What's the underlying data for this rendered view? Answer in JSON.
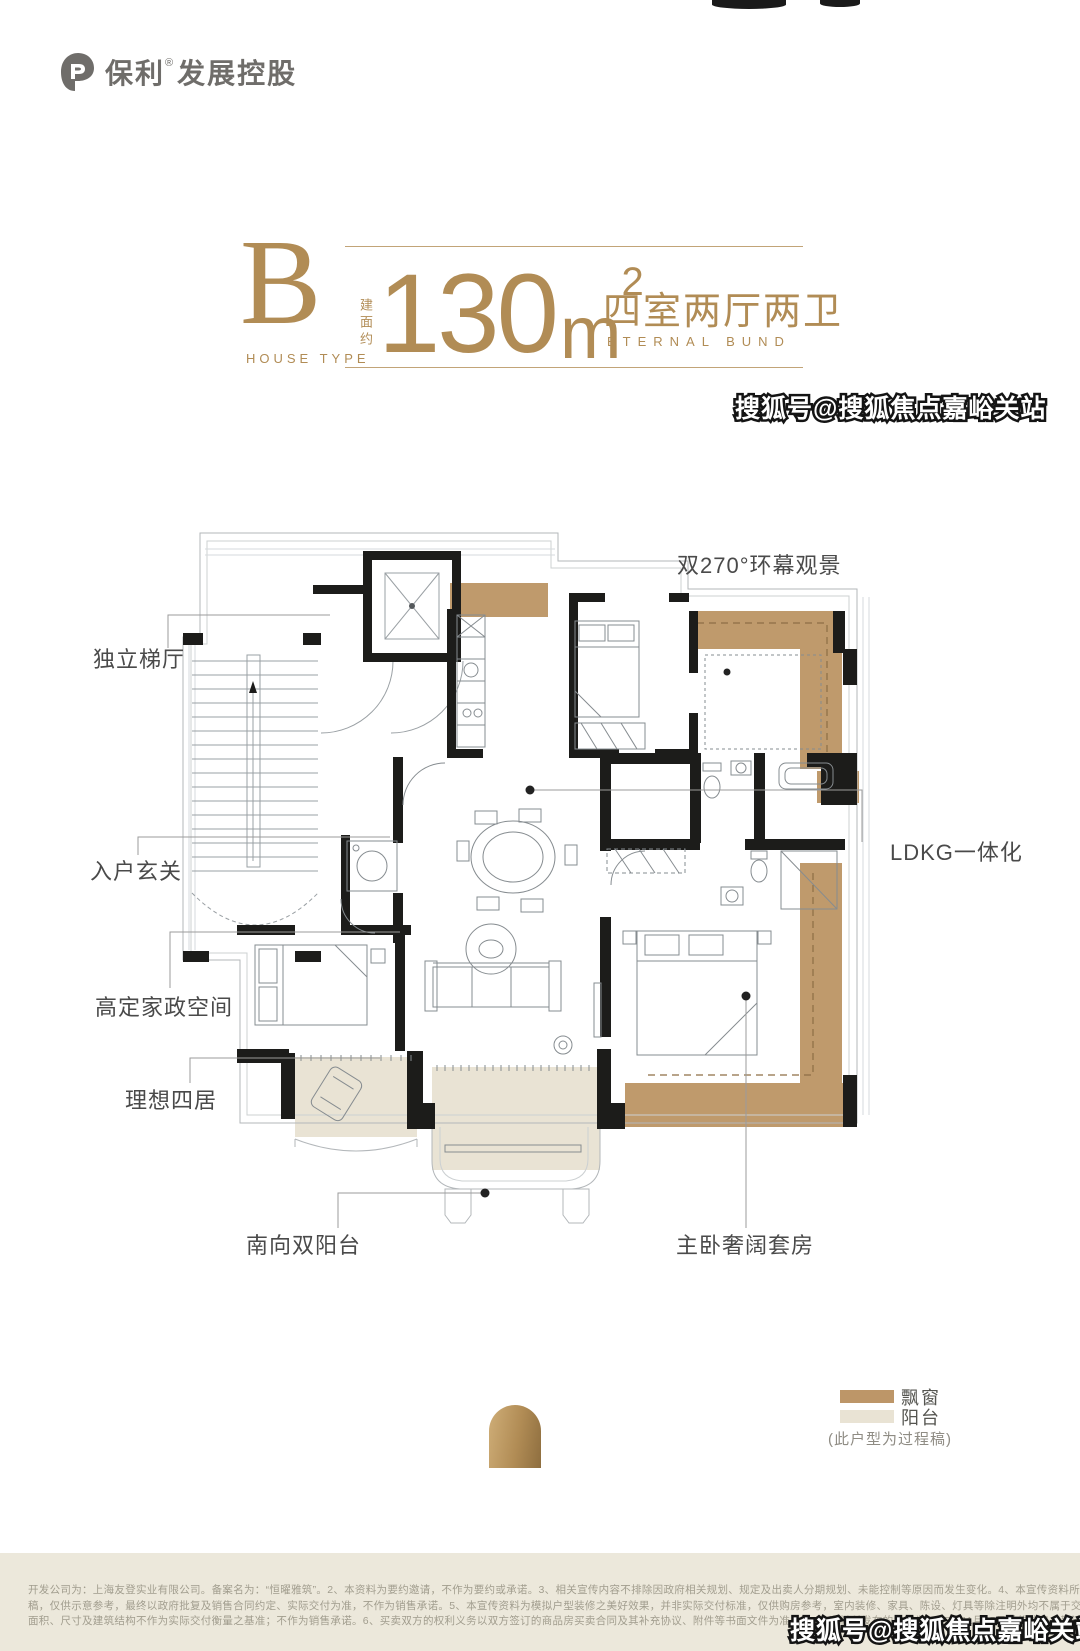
{
  "brand": {
    "name": "保利",
    "reg": "®",
    "suffix": "发展控股"
  },
  "watermark": {
    "text": "搜狐号@搜狐焦点嘉峪关站"
  },
  "title": {
    "letter": "B",
    "letter_caption": "HOUSE TYPE",
    "area_prefix": "建面约",
    "area_number": "130",
    "area_unit": "m",
    "area_exp": "2",
    "rooms_cn": "四室两厅两卫",
    "rooms_en": "ETERNAL BUND"
  },
  "plan": {
    "labels": {
      "view": "双270°环幕观景",
      "lift_hall": "独立梯厅",
      "foyer": "入户玄关",
      "ldkg": "LDKG一体化",
      "housework": "高定家政空间",
      "four_rooms": "理想四居",
      "south_balcony": "南向双阳台",
      "master_suite": "主卧奢阔套房"
    }
  },
  "legend": {
    "bay_window": "飘窗",
    "balcony": "阳台",
    "note": "(此户型为过程稿)",
    "bay_window_color": "#bd9668",
    "balcony_color": "#e9e3d4"
  },
  "colors": {
    "gold": "#b18c55",
    "wall": "#1c1c1a",
    "label_text": "#4a4a4a",
    "disclaimer_bg": "#ece8db"
  },
  "disclaimer": {
    "line1": "开发公司为：上海友登实业有限公司。备案名为：“恒曜雅筑”。2、本资料为要约邀请，不作为要约或承诺。3、相关宣传内容不排除因政府相关规划、规定及出卖人分期规划、未能控制等原因而发生变化。4、本宣传资料所涉及的户型为过程",
    "line2": "稿，仅供示意参考，最终以政府批复及销售合同约定、实际交付为准，不作为销售承诺。5、本宣传资料为模拟户型装修之美好效果，并非实际交付标准，仅供购房参考，室内装修、家具、陈设、灯具等除注明外均不属于交付范围。室内外所有",
    "line3": "面积、尺寸及建筑结构不作为实际交付衡量之基准；不作为销售承诺。6、买卖双方的权利义务以双方签订的商品房买卖合同及其补充协议、附件等书面文件为准。7、本资料所发布的内容为2025年11月25日前的信息，敬请留意最新资料。"
  }
}
